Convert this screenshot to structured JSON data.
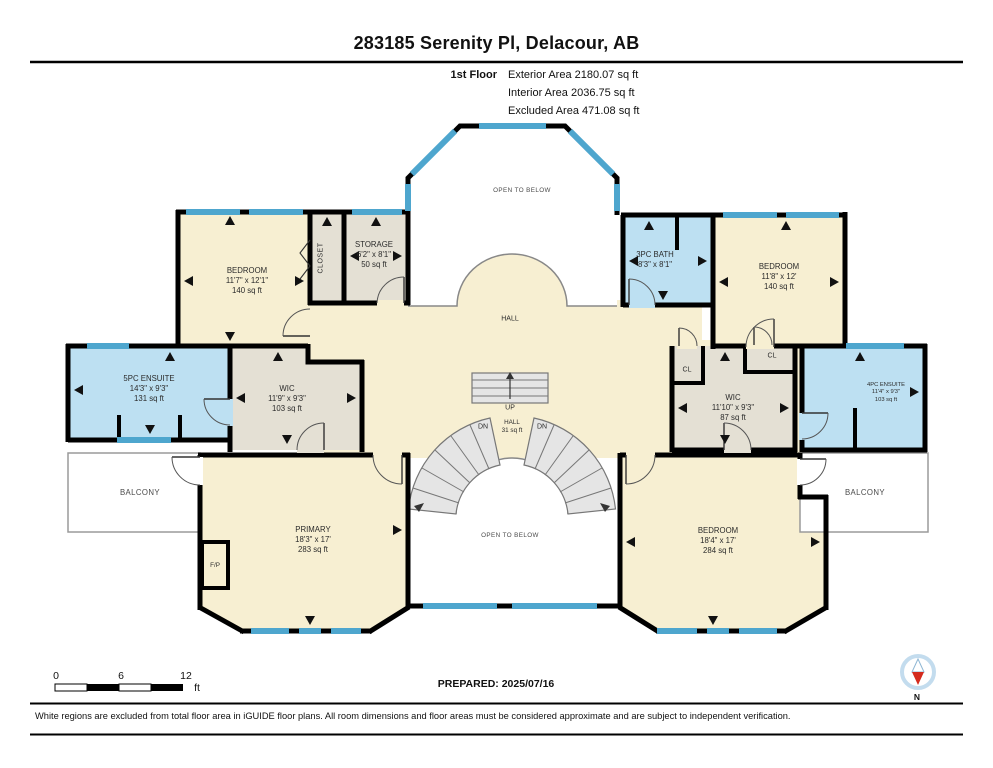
{
  "page": {
    "title": "283185 Serenity Pl, Delacour, AB"
  },
  "floor_info": {
    "floor_label": "1st Floor",
    "exterior": "Exterior Area 2180.07 sq ft",
    "interior": "Interior Area 2036.75 sq ft",
    "excluded": "Excluded Area 471.08 sq ft"
  },
  "rooms": {
    "open_below_top": {
      "name": "OPEN TO BELOW"
    },
    "bedroom_tl": {
      "name": "BEDROOM",
      "dims": "11'7\" x 12'1\"",
      "area": "140 sq ft"
    },
    "closet": {
      "name": "CLOSET"
    },
    "storage": {
      "name": "STORAGE",
      "dims": "6'2\" x 8'1\"",
      "area": "50 sq ft"
    },
    "hall": {
      "name": "HALL"
    },
    "bath_3pc": {
      "name": "3PC BATH",
      "dims": "8'3\" x 8'1\""
    },
    "bedroom_tr": {
      "name": "BEDROOM",
      "dims": "11'8\" x 12'",
      "area": "140 sq ft"
    },
    "ensuite_5pc": {
      "name": "5PC ENSUITE",
      "dims": "14'3\" x 9'3\"",
      "area": "131 sq ft"
    },
    "wic_left": {
      "name": "WIC",
      "dims": "11'9\" x 9'3\"",
      "area": "103 sq ft"
    },
    "stair_hall": {
      "name": "HALL",
      "area": "31 sq ft"
    },
    "cl_left": {
      "name": "CL"
    },
    "cl_top": {
      "name": "CL"
    },
    "wic_right": {
      "name": "WIC",
      "dims": "11'10\" x 9'3\"",
      "area": "87 sq ft"
    },
    "ensuite_4pc": {
      "name": "4PC ENSUITE",
      "dims": "11'4\" x 9'3\"",
      "area": "103 sq ft"
    },
    "balcony_left": {
      "name": "BALCONY"
    },
    "balcony_right": {
      "name": "BALCONY"
    },
    "primary": {
      "name": "PRIMARY",
      "dims": "18'3\" x 17'",
      "area": "283 sq ft"
    },
    "fireplace": {
      "name": "F/P"
    },
    "open_below_bottom": {
      "name": "OPEN TO BELOW"
    },
    "bedroom_br": {
      "name": "BEDROOM",
      "dims": "18'4\" x 17'",
      "area": "284 sq ft"
    }
  },
  "stairs": {
    "up": "UP",
    "dn_left": "DN",
    "dn_right": "DN"
  },
  "scale_bar": {
    "tick_0": "0",
    "tick_mid": "6",
    "tick_end": "12",
    "unit": "ft"
  },
  "compass": {
    "north_label": "N"
  },
  "footer": {
    "prepared": "PREPARED: 2025/07/16",
    "disclaimer": "White regions are excluded from total floor area in iGUIDE floor plans. All room dimensions and floor areas must be considered approximate and are subject to independent verification."
  },
  "colors": {
    "wall": "#000000",
    "window_blue": "#4EA6CE",
    "room_cream": "#F7EFD2",
    "room_blue": "#BDE0F2",
    "room_gray": "#E4E0D4",
    "stair_fill": "#E5E5E5",
    "compass_red": "#D42B1E"
  }
}
